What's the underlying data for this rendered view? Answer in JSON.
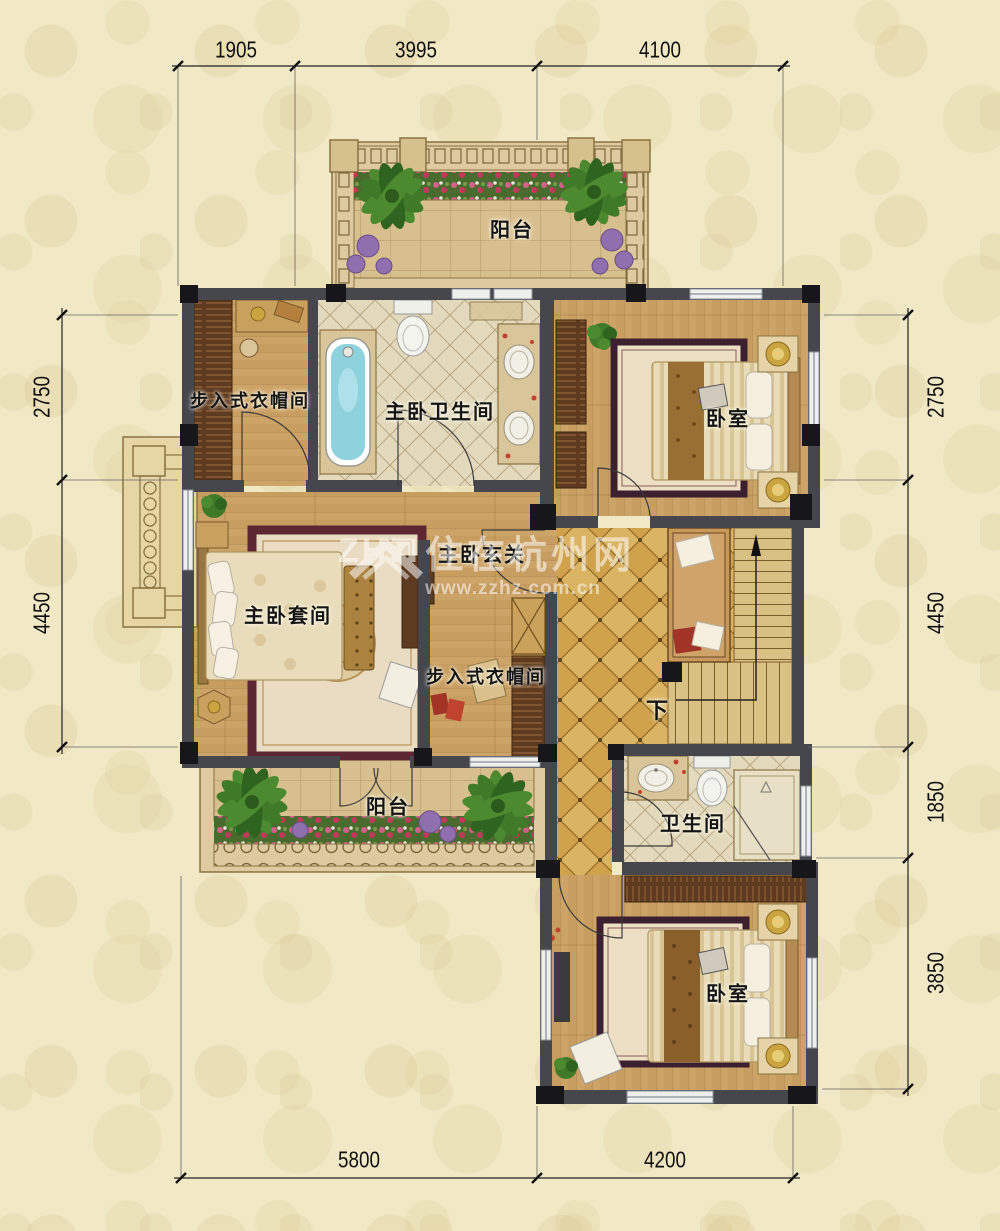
{
  "drawing": {
    "type": "residential-floor-plan",
    "wall_color": "#46464d",
    "background_color": "#f1e9c6",
    "gold_tile_color": "#cfa24b",
    "wood_color": "#c89d60"
  },
  "dimensions": {
    "top": [
      "1905",
      "3995",
      "4100"
    ],
    "bottom": [
      "5800",
      "4200"
    ],
    "left": [
      "2750",
      "4450"
    ],
    "right": [
      "2750",
      "4450",
      "1850",
      "3850"
    ]
  },
  "rooms": {
    "balcony_top": "阳台",
    "walkin_closet_top": "步入式衣帽间",
    "master_bath": "主卧卫生间",
    "bedroom_top": "卧室",
    "master_foyer": "主卧玄关",
    "master_suite": "主卧套间",
    "walkin_closet_lower": "步入式衣帽间",
    "stairs_down": "下",
    "balcony_lower": "阳台",
    "bath": "卫生间",
    "bedroom_bottom": "卧室"
  },
  "watermark": {
    "logo": "ZHZ",
    "site_name": "住在杭州网",
    "site_url": "www.zzhz.com.cn"
  }
}
